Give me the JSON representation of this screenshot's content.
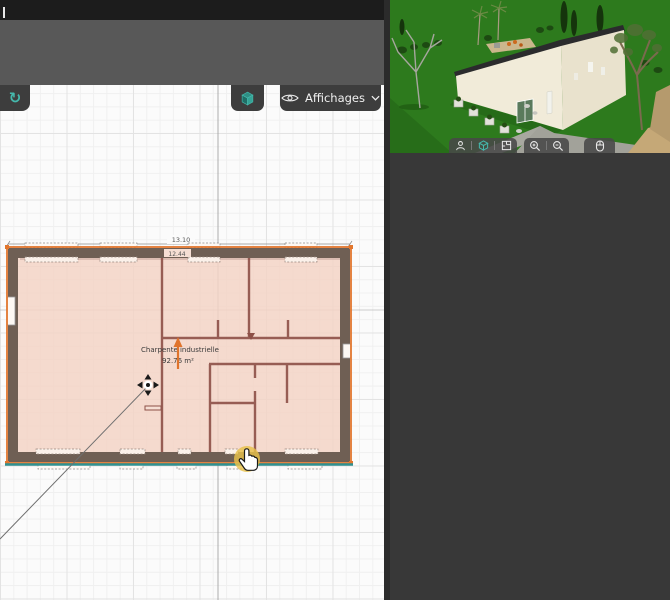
{
  "colors": {
    "accent_teal": "#45b8ac",
    "selection_orange": "#e2762d",
    "wall_brown": "#6f5f54",
    "floor_pink": "#f4d7c8",
    "selected_wall_teal": "#2f9090",
    "lawn_green": "#2d7a1d",
    "panel_dark": "#383838",
    "toolbar_gray": "#585858",
    "topbar_black": "#1c1c1c",
    "north_arrow_orange": "#e0742c",
    "cursor_yellow": "#e8c14a"
  },
  "toolbar_2d": {
    "snap_icon": "rotate-icon",
    "snap_glyph": "↻",
    "view_3d_icon": "cube-icon",
    "affichages": {
      "label": "Affichages",
      "icon": "eye-icon",
      "chevron": "chevron-down-icon"
    }
  },
  "plan": {
    "dim_width": "13.10",
    "dim_inner": "12.44",
    "room_label": "Charpente industrielle",
    "room_area": "92.76 m²"
  },
  "viewer_3d": {
    "toolbar_buttons": [
      {
        "name": "person"
      },
      {
        "name": "view-3d",
        "active": true
      },
      {
        "name": "floorplan"
      },
      {
        "name": "zoom-in"
      },
      {
        "name": "zoom-out"
      },
      {
        "name": "mouse"
      }
    ]
  }
}
